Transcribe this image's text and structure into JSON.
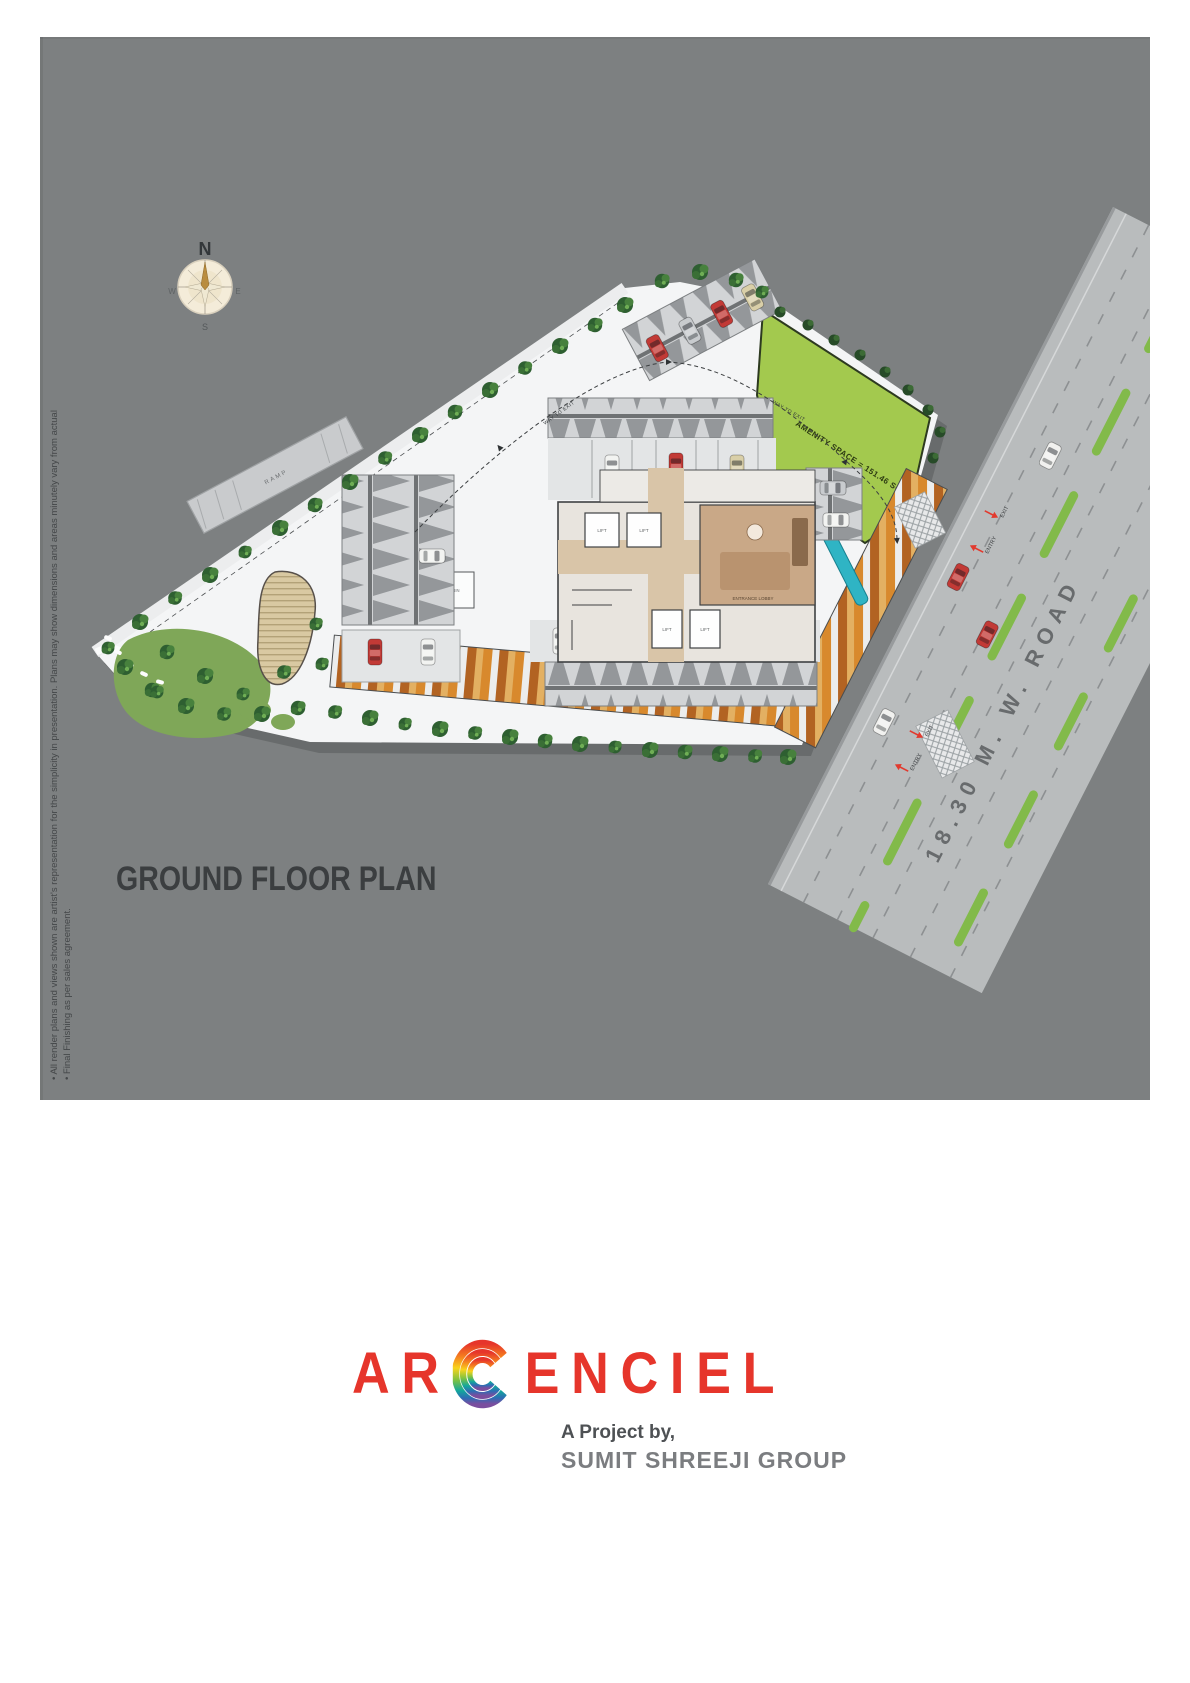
{
  "title": "GROUND FLOOR PLAN",
  "compass": {
    "north": "N",
    "east": "E",
    "south": "S",
    "west": "W"
  },
  "disclaimer": {
    "line1": "• All render plans and views shown are artist's representation for the simplicity in presentation. Plans may show dimensions and areas minutely vary from actual",
    "line2": "• Final Finishing as per sales agreement."
  },
  "plan": {
    "road_label": "18.30 M. W. ROAD",
    "amenity_space_label": "AMENITY SPACE = 151.46 SQ.MT.",
    "way_to_exit_label": "WAY TO EXIT",
    "entry_label": "ENTRY",
    "exit_label": "EXIT",
    "lift_label": "LIFT",
    "entrance_lobby_label": "ENTRANCE LOBBY",
    "ramp_label": "RAMP",
    "security_cabin_label": "SECURITY CABIN"
  },
  "branding": {
    "logo_prefix": "AR",
    "logo_suffix": "ENCIEL",
    "tagline": "A Project by,",
    "developer": "SUMIT SHREEJI GROUP"
  },
  "colors": {
    "accent_red": "#e6352b",
    "panel_gray": "#7d8081",
    "amenity_green": "#a3c94e",
    "road_gray": "#b9bcbd"
  }
}
